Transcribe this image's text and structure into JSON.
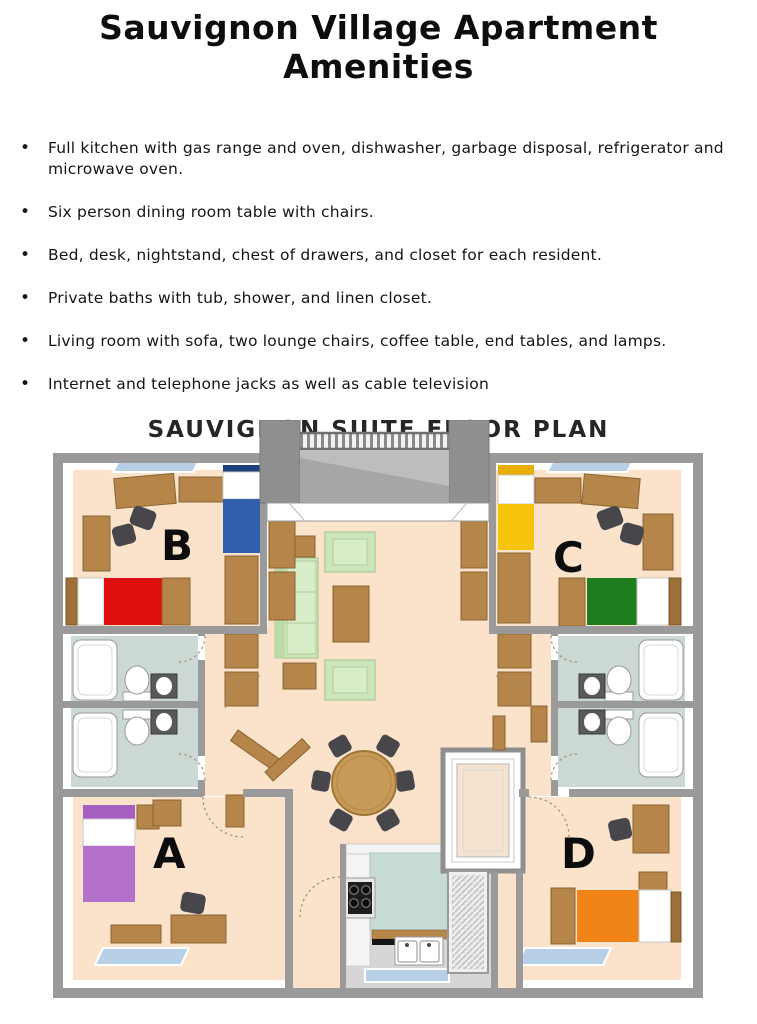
{
  "header": {
    "title": "Sauvignon Village Apartment Amenities"
  },
  "amenities": {
    "items": [
      "Full kitchen with gas range and oven, dishwasher, garbage disposal, refrigerator and microwave oven.",
      "Six person dining room table with chairs.",
      "Bed, desk, nightstand, chest of drawers, and closet for each resident.",
      "Private baths with tub, shower, and linen closet.",
      "Living room with sofa, two lounge chairs, coffee table, end tables, and lamps.",
      "Internet and telephone jacks as well as cable television"
    ]
  },
  "floor_plan": {
    "title": "SAUVIGNON SUITE FLOOR PLAN",
    "rooms": [
      {
        "id": "a",
        "label": "A"
      },
      {
        "id": "b",
        "label": "B"
      },
      {
        "id": "c",
        "label": "C"
      },
      {
        "id": "d",
        "label": "D"
      }
    ],
    "colors": {
      "floor_peach": "#fbe3cb",
      "wall_gray": "#9a9a9a",
      "bath_floor": "#cbd8d4",
      "kitchen_floor": "#d6d6d6",
      "kitchen_counter": "#c6dbd6",
      "wood": "#b5854a",
      "sofa_green": "#cde6bc",
      "bed_red": "#e01010",
      "bed_blue": "#2f5fae",
      "bed_yellow": "#f6c50a",
      "bed_green": "#1e7d1e",
      "bed_purple": "#b471cb",
      "bed_orange": "#f08418",
      "window_blue": "#b8cfe8"
    }
  }
}
